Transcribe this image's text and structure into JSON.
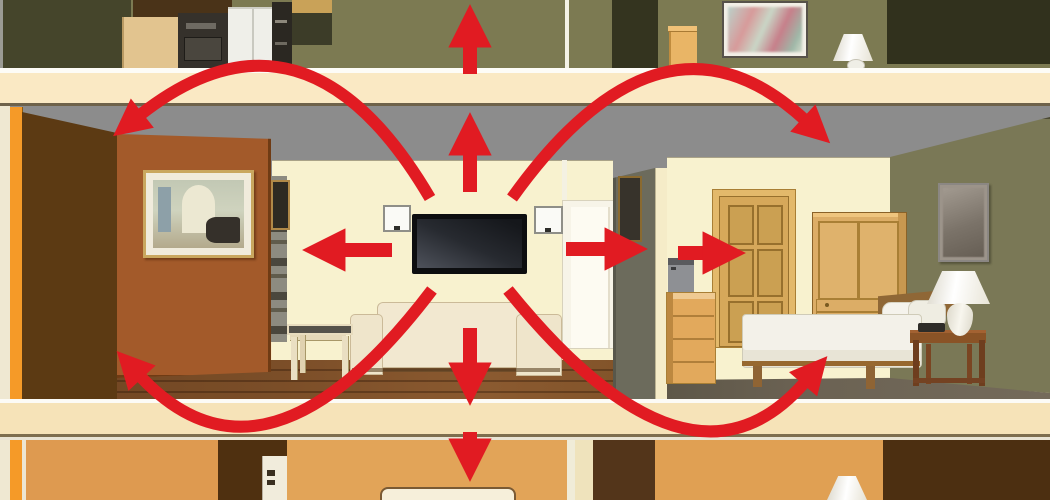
{
  "meta": {
    "description": "Cutaway dollhouse-style illustration of a two-storey house: red arrows radiate from a wall-mounted TV in the living room, showing sound travelling up through the ceiling, down through the floor, sideways through walls into the adjacent bedroom, and arcing into the rooms above and below.",
    "visible_text": "none — pure illustration, no text in image"
  },
  "palette": {
    "arrow_red": "#E11B22",
    "band_cream": "#FAE9C4",
    "band_cream_lower": "#F6E3B8",
    "ceiling_gray": "#8C8C8C",
    "wall_cream": "#F8F2CF",
    "wall_olive": "#7C7A52",
    "wall_olive_dark": "#45452B",
    "doorway_dark": "#34341F",
    "wall_brown_dark": "#5C3A13",
    "wall_brown": "#A35A2A",
    "accent_orange": "#F59A28",
    "floor_wood": "#7B4E28",
    "carpet_taupe": "#6B6253",
    "wood_tan": "#D6A85A",
    "lower_orange": "#DE9A50",
    "lower_brown": "#4F3010",
    "bedroom_green": "#7A7856"
  },
  "arrows": {
    "color": "#E11B22",
    "items": [
      {
        "name": "sound-up-into-upper-room-arrow",
        "shape": "straight",
        "d": "M470,74 L470,44",
        "width": 14
      },
      {
        "name": "sound-up-through-ceiling-arrow",
        "shape": "straight",
        "d": "M470,192 L470,152",
        "width": 14
      },
      {
        "name": "sound-left-into-wall-arrow",
        "shape": "straight",
        "d": "M392,250 L342,250",
        "width": 14
      },
      {
        "name": "sound-right-through-wall-arrow",
        "shape": "straight",
        "d": "M566,249 L608,249",
        "width": 14
      },
      {
        "name": "sound-right-into-bedroom-door-arrow",
        "shape": "straight",
        "d": "M678,253 L706,253",
        "width": 14
      },
      {
        "name": "sound-down-through-floor-arrow",
        "shape": "straight",
        "d": "M470,328 L470,366",
        "width": 14
      },
      {
        "name": "sound-down-into-lower-room-arrow",
        "shape": "straight",
        "d": "M470,432 L470,442",
        "width": 14
      },
      {
        "name": "sound-arc-upper-left-arrow",
        "shape": "curved",
        "d": "M430,198 Q305,-15 140,115",
        "width": 12
      },
      {
        "name": "sound-arc-upper-right-arrow",
        "shape": "curved",
        "d": "M512,198 Q662,-12 805,120",
        "width": 12
      },
      {
        "name": "sound-arc-lower-left-arrow",
        "shape": "curved",
        "d": "M432,290 Q265,510 140,376",
        "width": 12
      },
      {
        "name": "sound-arc-lower-right-arrow",
        "shape": "curved",
        "d": "M508,290 Q690,515 805,382",
        "width": 12
      }
    ]
  },
  "scene": {
    "upper_floor_strip": [
      "kitchen with cabinets, range, fridge and oven",
      "hallway with white door edge and dark doorway",
      "room with framed picture, tan pedestal and white table lamp"
    ],
    "main_floor": {
      "living_room": [
        "orange cut wall edge",
        "dark brown side wall",
        "brown wall with framed piano-room picture",
        "narrow bookshelf",
        "wall-mounted flat-screen TV",
        "left wall speaker",
        "right wall speaker",
        "cream sofa",
        "side table with dark top",
        "open white doorway",
        "wood plank floor"
      ],
      "bedroom": [
        "partition wall with small picture",
        "six-panel tan door",
        "tan armoire with drawers",
        "dresser with gray TV on top",
        "bed with white linens, wood headboard and pillows",
        "nightstand with phone",
        "white table lamp",
        "framed picture on green wall",
        "taupe carpet"
      ]
    },
    "lower_floor_strip": [
      "orange room with dark doorway and white door",
      "room with white bed headboard",
      "room with white lamp shade",
      "dark brown room at right"
    ]
  }
}
